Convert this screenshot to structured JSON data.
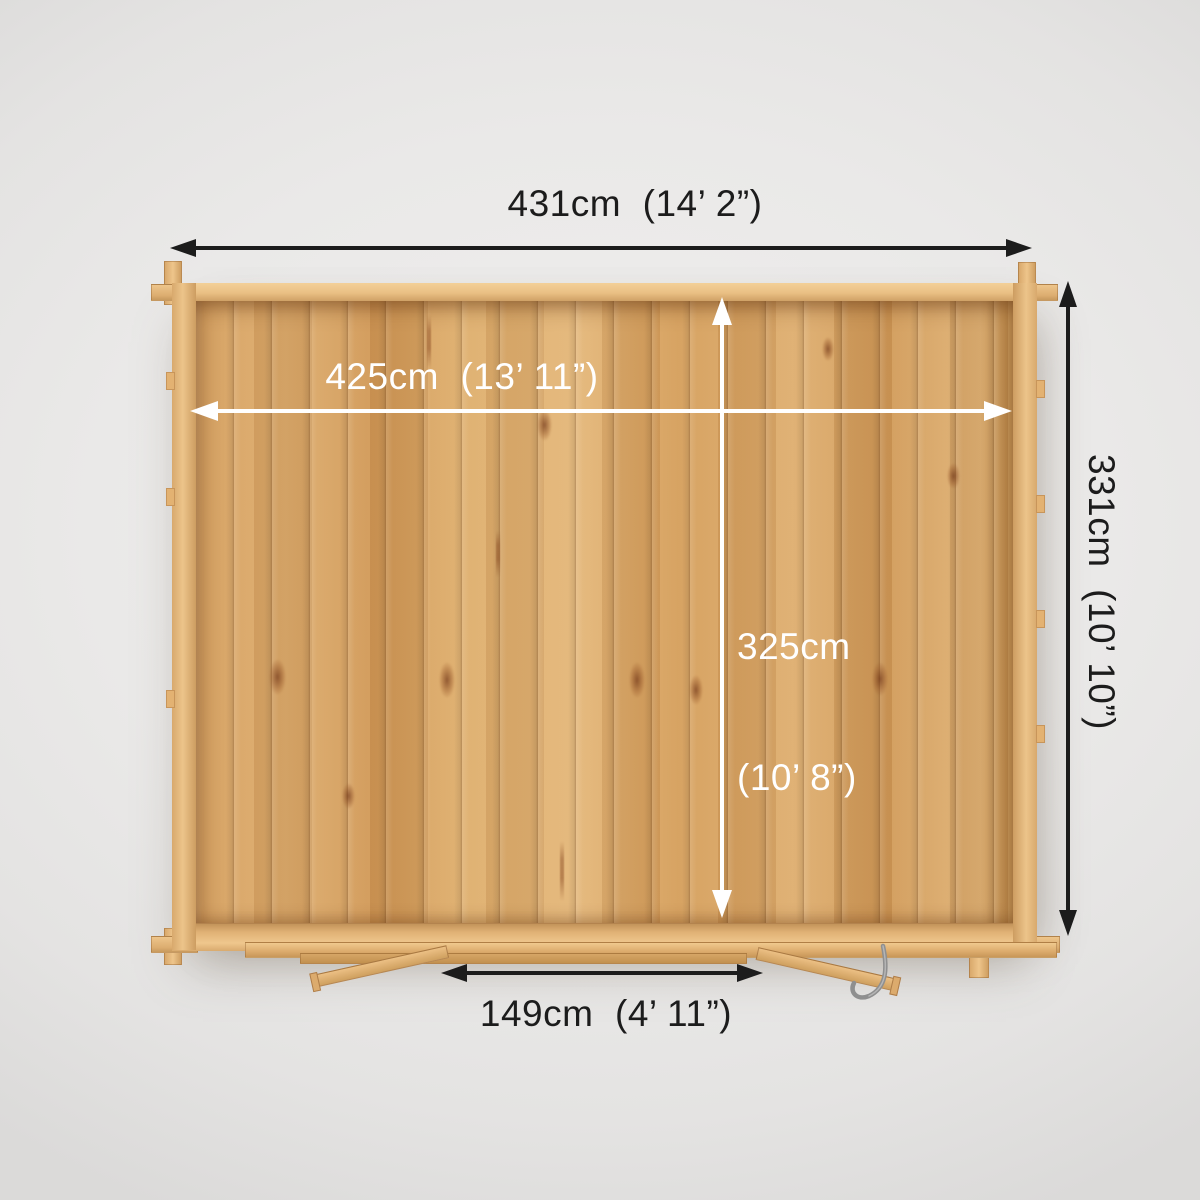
{
  "diagram": {
    "name": "Log cabin top-down dimension diagram",
    "dimensions": {
      "outer_width": {
        "label": "431cm  (14’ 2”)"
      },
      "inner_width": {
        "label": "425cm  (13’ 11”)"
      },
      "inner_depth": {
        "line1": "325cm",
        "line2": "(10’ 8”)"
      },
      "outer_depth": {
        "label": "331cm  (10’ 10”)"
      },
      "door_width": {
        "label": "149cm  (4’ 11”)"
      }
    },
    "colors": {
      "dimension_dark": "#1c1c1c",
      "dimension_light": "#ffffff",
      "wood_light": "#ecc48a",
      "wood_mid": "#d8a667",
      "wood_dark": "#c4934f",
      "background": "#e9e8e7"
    }
  }
}
